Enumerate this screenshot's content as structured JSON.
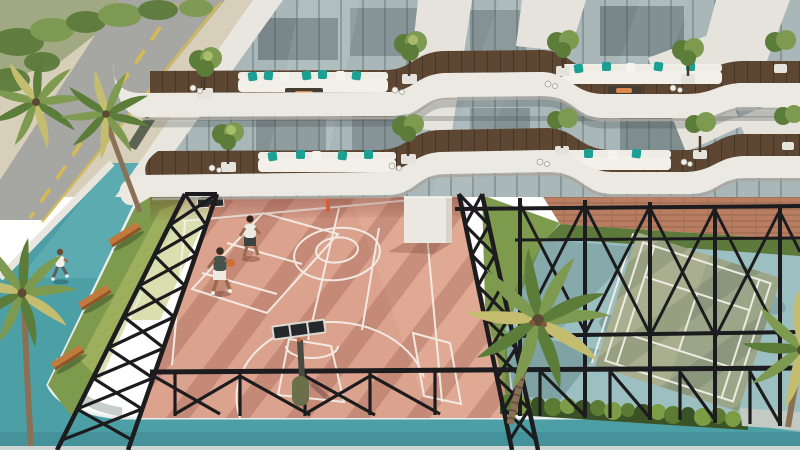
{
  "scene": {
    "type": "architectural-rendering",
    "view": "aerial-corner-view",
    "subject": "residential-building-podium-with-sports-amenities"
  },
  "palette": {
    "sand": "#d8cfba",
    "road": "#a6a6a2",
    "road-line": "#d6bb54",
    "track-teal": "#4d9fa6",
    "track-teal-light": "#6ab4b8",
    "track-teal-dark": "#3d8f97",
    "track-curb": "#e9efed",
    "concrete": "#c2cac4",
    "grass": "#7e9a4c",
    "grass-sun": "#bcc46e",
    "grass-dark": "#5d7a3c",
    "court-pink": "#dba28e",
    "court-pink-light": "#e5af99",
    "court-shadow": "#8d4636",
    "line-white": "#f4f1ea",
    "fence-black": "#1c1c1e",
    "court-blue": "#9cbfc1",
    "court-green": "#a9af8e",
    "court-green-shade": "#93a084",
    "brick": "#b97d62",
    "hedge-dark": "#3a5226",
    "hedge-mid": "#5d7c33",
    "hedge-light": "#7d9c46",
    "ribbon-white": "#ece9e2",
    "ribbon-shade": "#a9a49b",
    "deck-wood": "#5d4632",
    "sofa-white": "#efece5",
    "pillow-teal": "#1ba093",
    "glass-base": "#a9b7b9",
    "glass-dark": "#5f6d70",
    "mullion": "#6e7f86",
    "pier-white": "#e6e3dc",
    "palm-green": "#7d9a50",
    "palm-green-dark": "#5c7c3a",
    "palm-yellow": "#c4bd70",
    "trunk-brown": "#8a7055",
    "skin": "#9a6b4d",
    "ball-orange": "#cf6e35",
    "bench-wood": "#c07a3e",
    "pole-olive": "#6b6f4a",
    "fire-orange": "#d98a4a",
    "backboard-dark": "#25282a",
    "white-wall": "#e9e6df"
  },
  "building": {
    "visible_terrace_levels": 2,
    "terraces": [
      {
        "name": "upper-terrace",
        "sofa_groups": 2,
        "potted_trees": 5,
        "fire_tables": 2
      },
      {
        "name": "lower-terrace",
        "sofa_groups": 2,
        "potted_trees": 5,
        "fire_tables": 2
      }
    ]
  },
  "amenities": {
    "basketball_court": {
      "surface_color": "pink",
      "players": 2,
      "hoops": 2,
      "ball": 1
    },
    "tennis_court": {
      "surface_color": "green-on-blue"
    },
    "running_track": {
      "color": "teal",
      "joggers": 1
    },
    "benches": 3,
    "ground_palm_trees": 5,
    "hedge_bushes": 16,
    "white_cube_column": 1
  }
}
